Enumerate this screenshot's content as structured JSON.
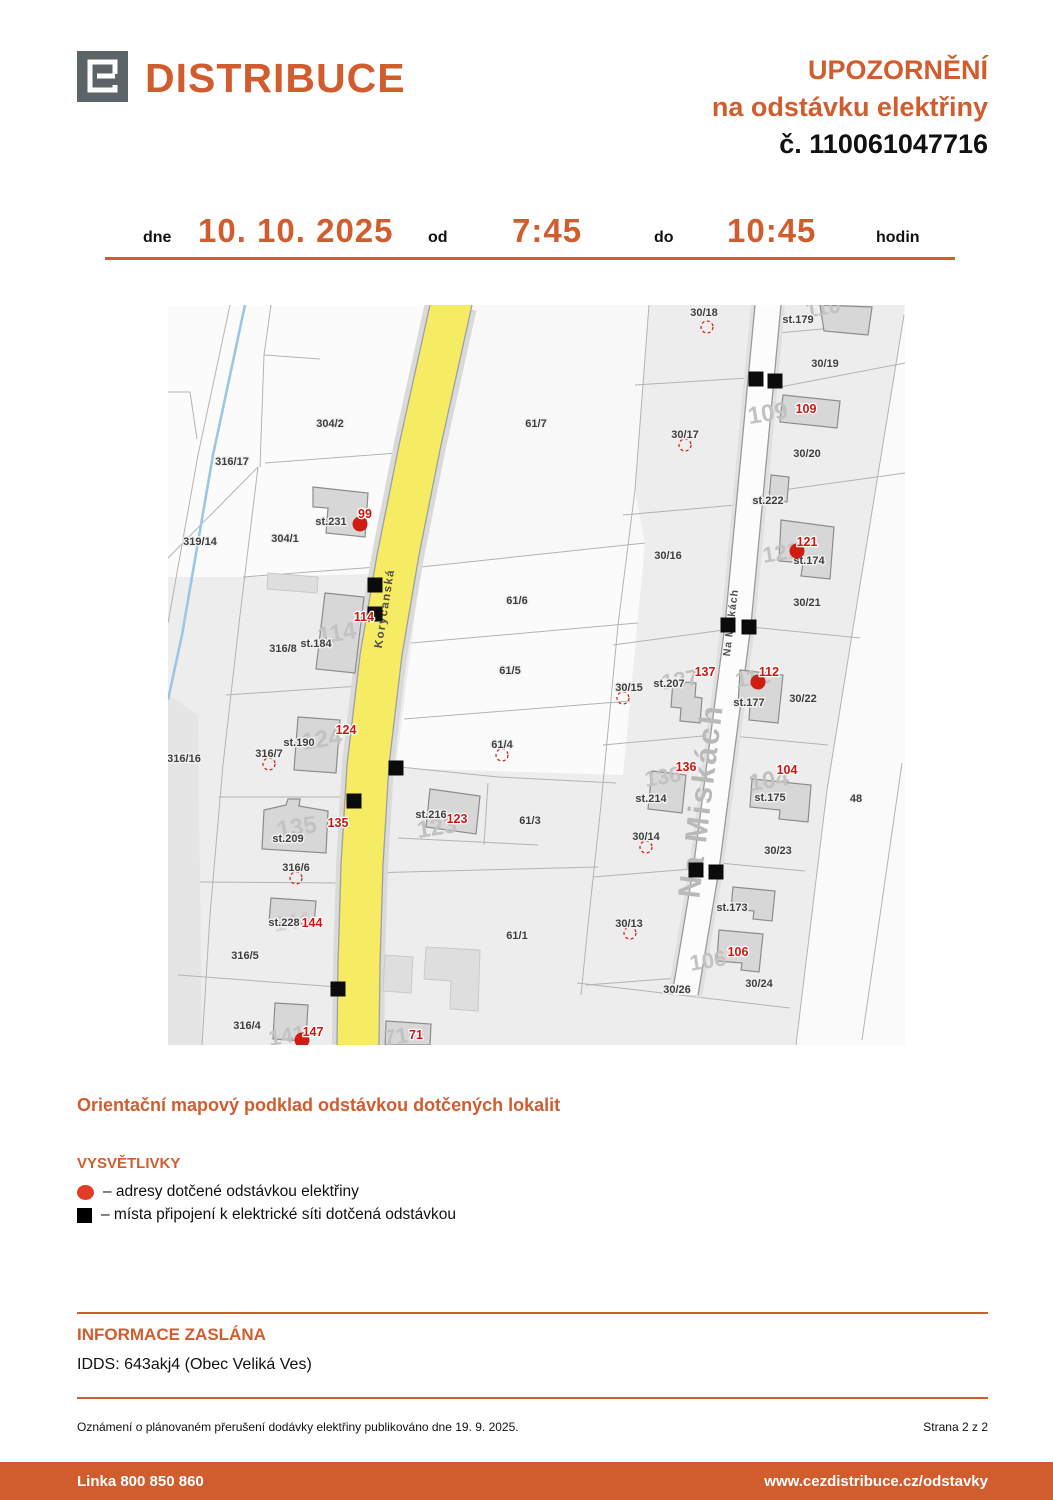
{
  "header": {
    "brand": "DISTRIBUCE",
    "notice_line1": "UPOZORNĚNÍ",
    "notice_line2": "na odstávku elektřiny",
    "notice_number": "č. 110061047716"
  },
  "schedule": {
    "dne_label": "dne",
    "date": "10. 10. 2025",
    "od_label": "od",
    "time_from": "7:45",
    "do_label": "do",
    "time_to": "10:45",
    "hodin_label": "hodin"
  },
  "map_title": "Orientační mapový podklad odstávkou dotčených lokalit",
  "legend": {
    "title": "VYSVĚTLIVKY",
    "items": [
      {
        "symbol": "red-dot",
        "text": "– adresy dotčené odstávkou elektřiny"
      },
      {
        "symbol": "black-square",
        "text": "– místa připojení k elektrické síti dotčená odstávkou"
      }
    ]
  },
  "info": {
    "title": "INFORMACE ZASLÁNA",
    "idds": "IDDS: 643akj4 (Obec Veliká Ves)"
  },
  "footnote": {
    "left": "Oznámení o plánovaném přerušení dodávky elektřiny publikováno dne 19. 9. 2025.",
    "right": "Strana 2 z 2"
  },
  "footer": {
    "phone": "Linka 800 850 860",
    "url": "www.cezdistribuce.cz/odstavky"
  },
  "colors": {
    "accent": "#d15d2e",
    "red": "#cf1d12",
    "road_yellow": "#f5ec63"
  },
  "map": {
    "streets": [
      {
        "t": "Korycanská",
        "x": 220,
        "y": 304,
        "rot": -81,
        "size": 11.5,
        "color": "#4f4f4f",
        "spacing": 1.5,
        "weight": 600
      },
      {
        "t": "Na Miskách",
        "x": 566,
        "y": 318,
        "rot": -83,
        "size": 10.5,
        "color": "#4f4f4f",
        "spacing": 1,
        "weight": 600
      },
      {
        "t": "Na Miskách",
        "x": 543,
        "y": 497,
        "rot": -83,
        "size": 31,
        "color": "#b9b9b9",
        "spacing": 2.5,
        "weight": 700
      }
    ],
    "parcel_labels": [
      {
        "t": "304/2",
        "x": 162,
        "y": 122
      },
      {
        "t": "316/17",
        "x": 64,
        "y": 160
      },
      {
        "t": "319/14",
        "x": 32,
        "y": 240
      },
      {
        "t": "304/1",
        "x": 117,
        "y": 237
      },
      {
        "t": "st.231",
        "x": 163,
        "y": 220
      },
      {
        "t": "316/8",
        "x": 115,
        "y": 347
      },
      {
        "t": "st.184",
        "x": 148,
        "y": 342
      },
      {
        "t": "316/16",
        "x": 16,
        "y": 457
      },
      {
        "t": "316/7",
        "x": 101,
        "y": 452
      },
      {
        "t": "st.190",
        "x": 131,
        "y": 441
      },
      {
        "t": "st.209",
        "x": 120,
        "y": 537
      },
      {
        "t": "316/6",
        "x": 128,
        "y": 566
      },
      {
        "t": "st.228",
        "x": 116,
        "y": 621
      },
      {
        "t": "316/5",
        "x": 77,
        "y": 654
      },
      {
        "t": "316/4",
        "x": 79,
        "y": 724
      },
      {
        "t": "61/7",
        "x": 368,
        "y": 122
      },
      {
        "t": "61/6",
        "x": 349,
        "y": 299
      },
      {
        "t": "61/5",
        "x": 342,
        "y": 369
      },
      {
        "t": "61/4",
        "x": 334,
        "y": 443
      },
      {
        "t": "61/3",
        "x": 362,
        "y": 519
      },
      {
        "t": "st.216",
        "x": 263,
        "y": 513
      },
      {
        "t": "61/1",
        "x": 349,
        "y": 634
      },
      {
        "t": "30/18",
        "x": 536,
        "y": 11
      },
      {
        "t": "st.179",
        "x": 630,
        "y": 18
      },
      {
        "t": "30/19",
        "x": 657,
        "y": 62
      },
      {
        "t": "30/17",
        "x": 517,
        "y": 133
      },
      {
        "t": "30/20",
        "x": 639,
        "y": 152
      },
      {
        "t": "st.222",
        "x": 600,
        "y": 199
      },
      {
        "t": "st.174",
        "x": 641,
        "y": 259
      },
      {
        "t": "30/16",
        "x": 500,
        "y": 254
      },
      {
        "t": "30/21",
        "x": 639,
        "y": 301
      },
      {
        "t": "30/15",
        "x": 461,
        "y": 386
      },
      {
        "t": "st.207",
        "x": 501,
        "y": 382
      },
      {
        "t": "st.177",
        "x": 581,
        "y": 401
      },
      {
        "t": "30/22",
        "x": 635,
        "y": 397
      },
      {
        "t": "st.214",
        "x": 483,
        "y": 497
      },
      {
        "t": "st.175",
        "x": 602,
        "y": 496
      },
      {
        "t": "30/14",
        "x": 478,
        "y": 535
      },
      {
        "t": "30/23",
        "x": 610,
        "y": 549
      },
      {
        "t": "48",
        "x": 688,
        "y": 497
      },
      {
        "t": "30/13",
        "x": 461,
        "y": 622
      },
      {
        "t": "st.173",
        "x": 564,
        "y": 606
      },
      {
        "t": "30/26",
        "x": 509,
        "y": 688
      },
      {
        "t": "30/24",
        "x": 591,
        "y": 682
      }
    ],
    "red_labels": [
      {
        "t": "99",
        "x": 197,
        "y": 213
      },
      {
        "t": "114",
        "x": 196,
        "y": 316
      },
      {
        "t": "124",
        "x": 178,
        "y": 429
      },
      {
        "t": "135",
        "x": 170,
        "y": 522
      },
      {
        "t": "144",
        "x": 144,
        "y": 622
      },
      {
        "t": "147",
        "x": 145,
        "y": 731
      },
      {
        "t": "123",
        "x": 289,
        "y": 518
      },
      {
        "t": "71",
        "x": 248,
        "y": 734
      },
      {
        "t": "109",
        "x": 638,
        "y": 108
      },
      {
        "t": "121",
        "x": 639,
        "y": 241
      },
      {
        "t": "137",
        "x": 537,
        "y": 371
      },
      {
        "t": "112",
        "x": 601,
        "y": 371
      },
      {
        "t": "136",
        "x": 518,
        "y": 466
      },
      {
        "t": "104",
        "x": 619,
        "y": 469
      },
      {
        "t": "106",
        "x": 570,
        "y": 651
      }
    ],
    "gray_numbers": [
      {
        "t": "114",
        "x": 170,
        "y": 336,
        "s": 24
      },
      {
        "t": "124",
        "x": 155,
        "y": 442,
        "s": 24
      },
      {
        "t": "135",
        "x": 130,
        "y": 530,
        "s": 24
      },
      {
        "t": "144",
        "x": 125,
        "y": 624,
        "s": 22,
        "o": 0.55
      },
      {
        "t": "109",
        "x": 601,
        "y": 116,
        "s": 24
      },
      {
        "t": "123",
        "x": 270,
        "y": 530,
        "s": 24
      },
      {
        "t": "136",
        "x": 496,
        "y": 479,
        "s": 22
      },
      {
        "t": "104",
        "x": 602,
        "y": 483,
        "s": 24
      },
      {
        "t": "106",
        "x": 541,
        "y": 663,
        "s": 22
      },
      {
        "t": "112",
        "x": 586,
        "y": 380,
        "s": 22
      },
      {
        "t": "137",
        "x": 513,
        "y": 382,
        "s": 22
      },
      {
        "t": "121",
        "x": 614,
        "y": 255,
        "s": 22
      },
      {
        "t": "110",
        "x": 656,
        "y": 10,
        "s": 22
      },
      {
        "t": "141",
        "x": 120,
        "y": 738,
        "s": 22
      },
      {
        "t": "71",
        "x": 229,
        "y": 739,
        "s": 22
      }
    ],
    "black_squares": [
      [
        588,
        74
      ],
      [
        607,
        76
      ],
      [
        560,
        320
      ],
      [
        581,
        322
      ],
      [
        207,
        280
      ],
      [
        207,
        309
      ],
      [
        228,
        463
      ],
      [
        186,
        496
      ],
      [
        170,
        684
      ],
      [
        528,
        565
      ],
      [
        548,
        567
      ]
    ],
    "red_dots": [
      [
        192,
        219
      ],
      [
        629,
        246
      ],
      [
        590,
        377
      ],
      [
        134,
        735
      ]
    ],
    "dashed_circles": [
      [
        539,
        22
      ],
      [
        517,
        140
      ],
      [
        455,
        393
      ],
      [
        478,
        542
      ],
      [
        462,
        628
      ],
      [
        334,
        450
      ],
      [
        101,
        459
      ],
      [
        128,
        573
      ]
    ]
  }
}
